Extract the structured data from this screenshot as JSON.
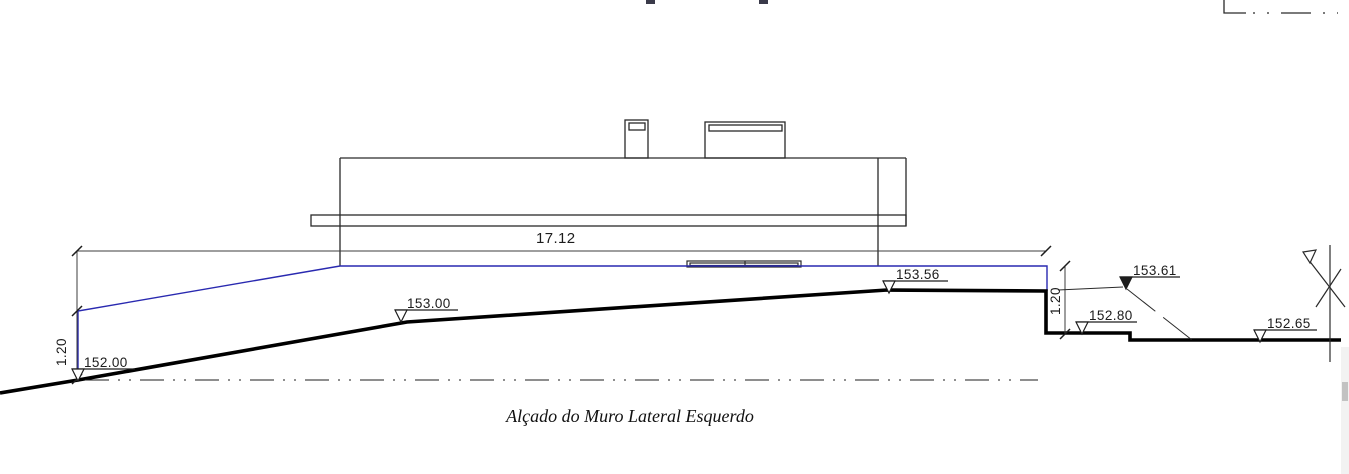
{
  "drawing": {
    "title": "Alçado do Muro Lateral Esquerdo",
    "dimension_labels": {
      "wall_length": "17.12",
      "wall_height_left": "1.20",
      "wall_height_right": "1.20"
    },
    "elevation_markers": [
      {
        "value": "152.00",
        "symbol": "open-triangle"
      },
      {
        "value": "153.00",
        "symbol": "open-triangle"
      },
      {
        "value": "153.56",
        "symbol": "open-triangle"
      },
      {
        "value": "153.61",
        "symbol": "filled-triangle"
      },
      {
        "value": "152.80",
        "symbol": "open-triangle"
      },
      {
        "value": "152.65",
        "symbol": "open-triangle"
      }
    ],
    "colors": {
      "outline": "#2a2a2a",
      "ground": "#000000",
      "wall_top_blue": "#2929b0",
      "dimension": "#3c3c3c"
    }
  }
}
